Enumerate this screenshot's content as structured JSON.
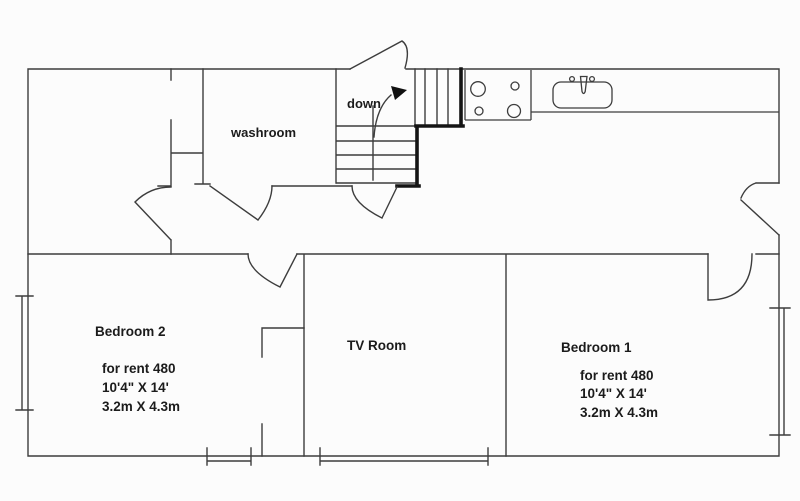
{
  "plan": {
    "type": "upper-floor plan",
    "colors": {
      "wall": "#3d3d3d",
      "bold_wall": "#141414",
      "text": "#1b1b1b",
      "background": "#fcfcfc"
    },
    "rooms": {
      "washroom": {
        "label": "washroom"
      },
      "stairs": {
        "label": "down"
      },
      "tv_room": {
        "label": "TV Room"
      },
      "bedroom2": {
        "name": "Bedroom 2",
        "rent": "for rent 480",
        "size_imperial": "10'4\" X 14'",
        "size_metric": "3.2m X 4.3m"
      },
      "bedroom1": {
        "name": "Bedroom 1",
        "rent": "for rent 480",
        "size_imperial": "10'4\" X 14'",
        "size_metric": "3.2m X 4.3m"
      }
    },
    "fixtures": {
      "stove_burners": 4,
      "kitchen_sink": 1,
      "windows": 4,
      "stair_direction": "down"
    }
  }
}
